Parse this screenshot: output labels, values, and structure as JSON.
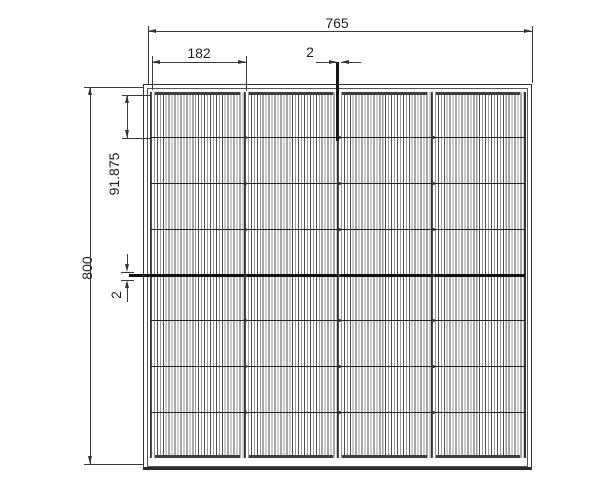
{
  "drawing": {
    "type": "solar-panel-dimension-drawing",
    "background_color": "#ffffff",
    "line_color": "#333333",
    "text_color": "#1f1f1f",
    "panel": {
      "columns": 4,
      "rows": 8,
      "row_line_thick_index": 4
    },
    "dimensions": {
      "overall_width": {
        "value": "765"
      },
      "cell_column_width": {
        "value": "182"
      },
      "column_gap": {
        "value": "2"
      },
      "overall_height": {
        "value": "800"
      },
      "cell_row_height": {
        "value": "91.875"
      },
      "row_gap": {
        "value": "2"
      }
    }
  }
}
